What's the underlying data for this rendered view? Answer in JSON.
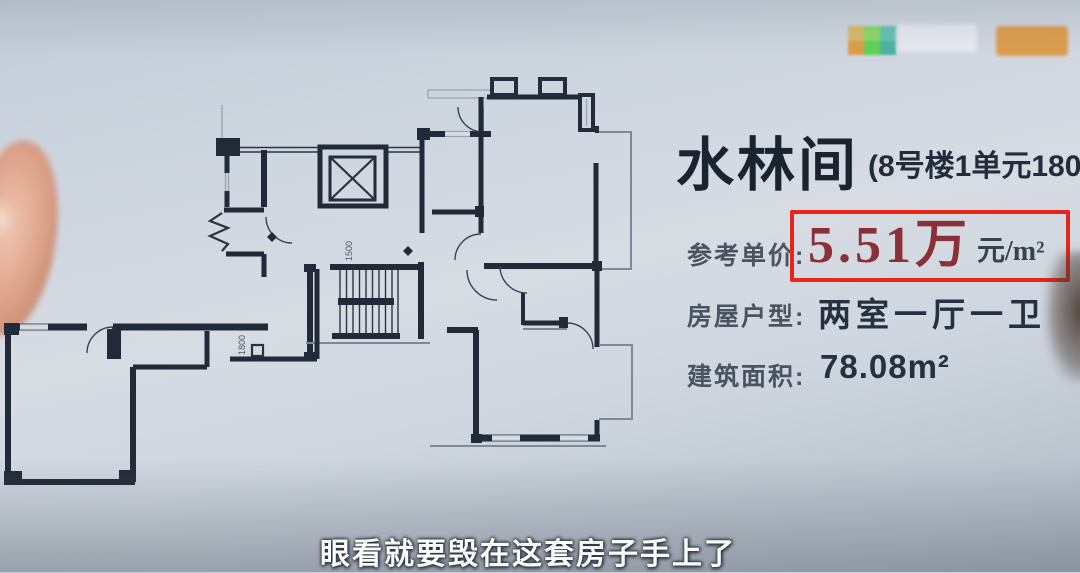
{
  "header": {
    "title": "水林间",
    "unit_info": "(8号楼1单元1802"
  },
  "listing": {
    "price_label": "参考单价:",
    "price_value": "5.51万",
    "price_unit": "元/m²",
    "layout_label": "房屋户型:",
    "layout_value": "两室一厅一卫",
    "area_label": "建筑面积:",
    "area_value": "78.08m²"
  },
  "floorplan": {
    "dim_label_1": "1800",
    "dim_label_2": "1500"
  },
  "subtitle": "眼看就要毁在这套房子手上了",
  "colors": {
    "highlight_box_red": "#e52618",
    "price_text_red": "#8b3036",
    "wall_ink": "#222938",
    "paper": "#d3d9e1"
  }
}
